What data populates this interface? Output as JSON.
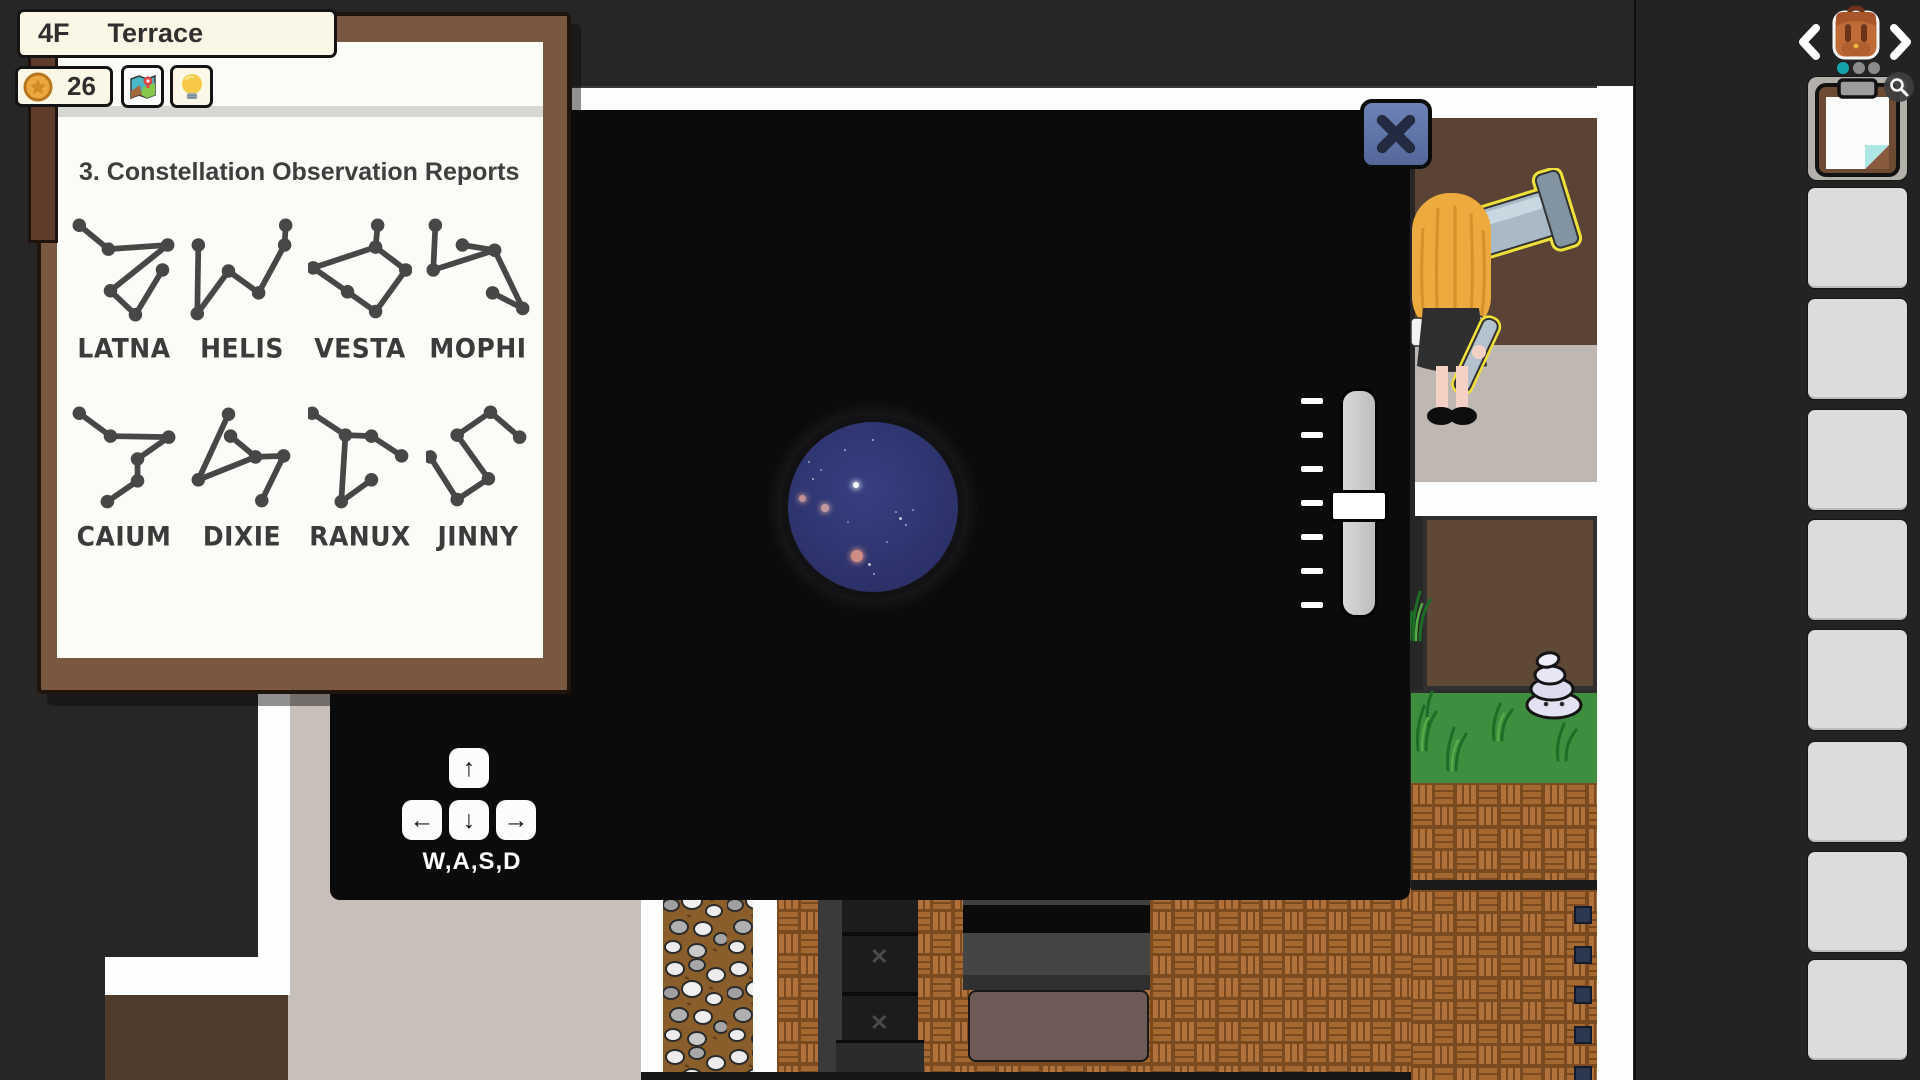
{
  "header": {
    "floor": "4F",
    "room": "Terrace"
  },
  "hud": {
    "coins": "26",
    "coin_icon": "coin-icon",
    "map_button_icon": "map-icon",
    "hint_button_icon": "lightbulb-icon"
  },
  "report_panel": {
    "title": "3. Constellation Observation Reports",
    "ink_color": "#474747",
    "constellations": [
      {
        "name": "LATNA",
        "points": [
          [
            7,
            6
          ],
          [
            35,
            29
          ],
          [
            92,
            25
          ],
          [
            87,
            49
          ],
          [
            37,
            69
          ],
          [
            61,
            92
          ]
        ],
        "edges": [
          [
            0,
            1
          ],
          [
            1,
            2
          ],
          [
            2,
            4
          ],
          [
            4,
            5
          ],
          [
            5,
            3
          ]
        ]
      },
      {
        "name": "HELIS",
        "points": [
          [
            8,
            25
          ],
          [
            7,
            91
          ],
          [
            37,
            50
          ],
          [
            66,
            71
          ],
          [
            91,
            25
          ],
          [
            92,
            6
          ]
        ],
        "edges": [
          [
            0,
            1
          ],
          [
            1,
            2
          ],
          [
            2,
            3
          ],
          [
            3,
            4
          ],
          [
            4,
            5
          ]
        ]
      },
      {
        "name": "VESTA",
        "points": [
          [
            5,
            47
          ],
          [
            65,
            27
          ],
          [
            67,
            6
          ],
          [
            94,
            49
          ],
          [
            38,
            70
          ],
          [
            65,
            89
          ]
        ],
        "edges": [
          [
            2,
            1
          ],
          [
            1,
            0
          ],
          [
            1,
            3
          ],
          [
            0,
            4
          ],
          [
            4,
            5
          ],
          [
            5,
            3
          ]
        ]
      },
      {
        "name": "MOPHI",
        "points": [
          [
            9,
            6
          ],
          [
            7,
            49
          ],
          [
            35,
            25
          ],
          [
            66,
            30
          ],
          [
            64,
            71
          ],
          [
            93,
            86
          ]
        ],
        "edges": [
          [
            0,
            1
          ],
          [
            2,
            3
          ],
          [
            1,
            3
          ],
          [
            3,
            5
          ],
          [
            4,
            5
          ]
        ]
      },
      {
        "name": "CAIUM",
        "points": [
          [
            7,
            6
          ],
          [
            37,
            28
          ],
          [
            93,
            29
          ],
          [
            63,
            50
          ],
          [
            63,
            71
          ],
          [
            34,
            91
          ]
        ],
        "edges": [
          [
            0,
            1
          ],
          [
            1,
            2
          ],
          [
            2,
            3
          ],
          [
            3,
            4
          ],
          [
            4,
            5
          ]
        ]
      },
      {
        "name": "DIXIE",
        "points": [
          [
            37,
            7
          ],
          [
            39,
            28
          ],
          [
            63,
            48
          ],
          [
            8,
            70
          ],
          [
            90,
            47
          ],
          [
            69,
            90
          ]
        ],
        "edges": [
          [
            0,
            3
          ],
          [
            3,
            2
          ],
          [
            1,
            2
          ],
          [
            2,
            4
          ],
          [
            4,
            5
          ]
        ]
      },
      {
        "name": "RANUX",
        "points": [
          [
            4,
            6
          ],
          [
            36,
            27
          ],
          [
            61,
            28
          ],
          [
            90,
            47
          ],
          [
            61,
            70
          ],
          [
            32,
            91
          ]
        ],
        "edges": [
          [
            0,
            1
          ],
          [
            1,
            2
          ],
          [
            2,
            3
          ],
          [
            1,
            5
          ],
          [
            5,
            4
          ]
        ]
      },
      {
        "name": "JINNY",
        "points": [
          [
            62,
            5
          ],
          [
            30,
            27
          ],
          [
            90,
            29
          ],
          [
            4,
            48
          ],
          [
            60,
            69
          ],
          [
            30,
            89
          ]
        ],
        "edges": [
          [
            1,
            0
          ],
          [
            0,
            2
          ],
          [
            1,
            4
          ],
          [
            4,
            5
          ],
          [
            3,
            5
          ]
        ]
      }
    ]
  },
  "telescope": {
    "close_icon": "x-icon",
    "view": {
      "inner_color": "#373f82",
      "outer_color": "#272c5e",
      "stars": [
        {
          "x": 68,
          "y": 63,
          "r": 3.2,
          "c": "#ffffff",
          "o": 1
        },
        {
          "x": 14,
          "y": 76,
          "r": 3.5,
          "c": "#c99595",
          "o": 0.95
        },
        {
          "x": 37,
          "y": 86,
          "r": 4,
          "c": "#c8a0a0",
          "o": 0.95
        },
        {
          "x": 69,
          "y": 134,
          "r": 6,
          "c": "#cf8d85",
          "o": 1
        },
        {
          "x": 25,
          "y": 57,
          "r": 1.3,
          "c": "#ffffff",
          "o": 0.6
        },
        {
          "x": 33,
          "y": 48,
          "r": 1.2,
          "c": "#ffffff",
          "o": 0.5
        },
        {
          "x": 21,
          "y": 40,
          "r": 1.2,
          "c": "#ffffff",
          "o": 0.55
        },
        {
          "x": 57,
          "y": 28,
          "r": 1.3,
          "c": "#ffffff",
          "o": 0.6
        },
        {
          "x": 85,
          "y": 18,
          "r": 1.4,
          "c": "#ffffff",
          "o": 0.6
        },
        {
          "x": 112,
          "y": 96,
          "r": 1.5,
          "c": "#ffffff",
          "o": 0.7
        },
        {
          "x": 118,
          "y": 103,
          "r": 1.3,
          "c": "#ffffff",
          "o": 0.55
        },
        {
          "x": 108,
          "y": 90,
          "r": 1.2,
          "c": "#ffffff",
          "o": 0.5
        },
        {
          "x": 125,
          "y": 88,
          "r": 1.2,
          "c": "#ffffff",
          "o": 0.5
        },
        {
          "x": 81,
          "y": 142,
          "r": 1.5,
          "c": "#ffffff",
          "o": 0.7
        },
        {
          "x": 86,
          "y": 152,
          "r": 1.3,
          "c": "#ffffff",
          "o": 0.55
        },
        {
          "x": 99,
          "y": 120,
          "r": 1.2,
          "c": "#ffffff",
          "o": 0.5
        },
        {
          "x": 60,
          "y": 100,
          "r": 1.1,
          "c": "#ffffff",
          "o": 0.4
        }
      ]
    },
    "slider": {
      "tick_count": 7,
      "handle_position": 0.51
    }
  },
  "movement_hint": {
    "label": "W,A,S,D",
    "keys": [
      {
        "name": "key-w",
        "glyph": "↑"
      },
      {
        "name": "key-a",
        "glyph": "←"
      },
      {
        "name": "key-s",
        "glyph": "↓"
      },
      {
        "name": "key-d",
        "glyph": "→"
      }
    ]
  },
  "sidebar": {
    "prev_icon": "chevron-left-icon",
    "next_icon": "chevron-right-icon",
    "tab_icon": "backpack-icon",
    "page_dots": [
      {
        "active": true
      },
      {
        "active": false
      },
      {
        "active": false
      }
    ],
    "first_slot_item": "clipboard-report",
    "first_slot_badge": "magnifier-icon",
    "empty_slot_count": 8,
    "empty_slot_tops": [
      188,
      299,
      410,
      520,
      630,
      742,
      852,
      960
    ]
  },
  "colors": {
    "accent_teal": "#14a3aa",
    "close_button_blue": "#6076ab",
    "highlight_yellow": "#f0e03a",
    "coin_gold": "#eda73f",
    "view_navy": "#2e3470",
    "panel_black": "#0b0b0b",
    "paper_cream": "#faf7e6"
  }
}
